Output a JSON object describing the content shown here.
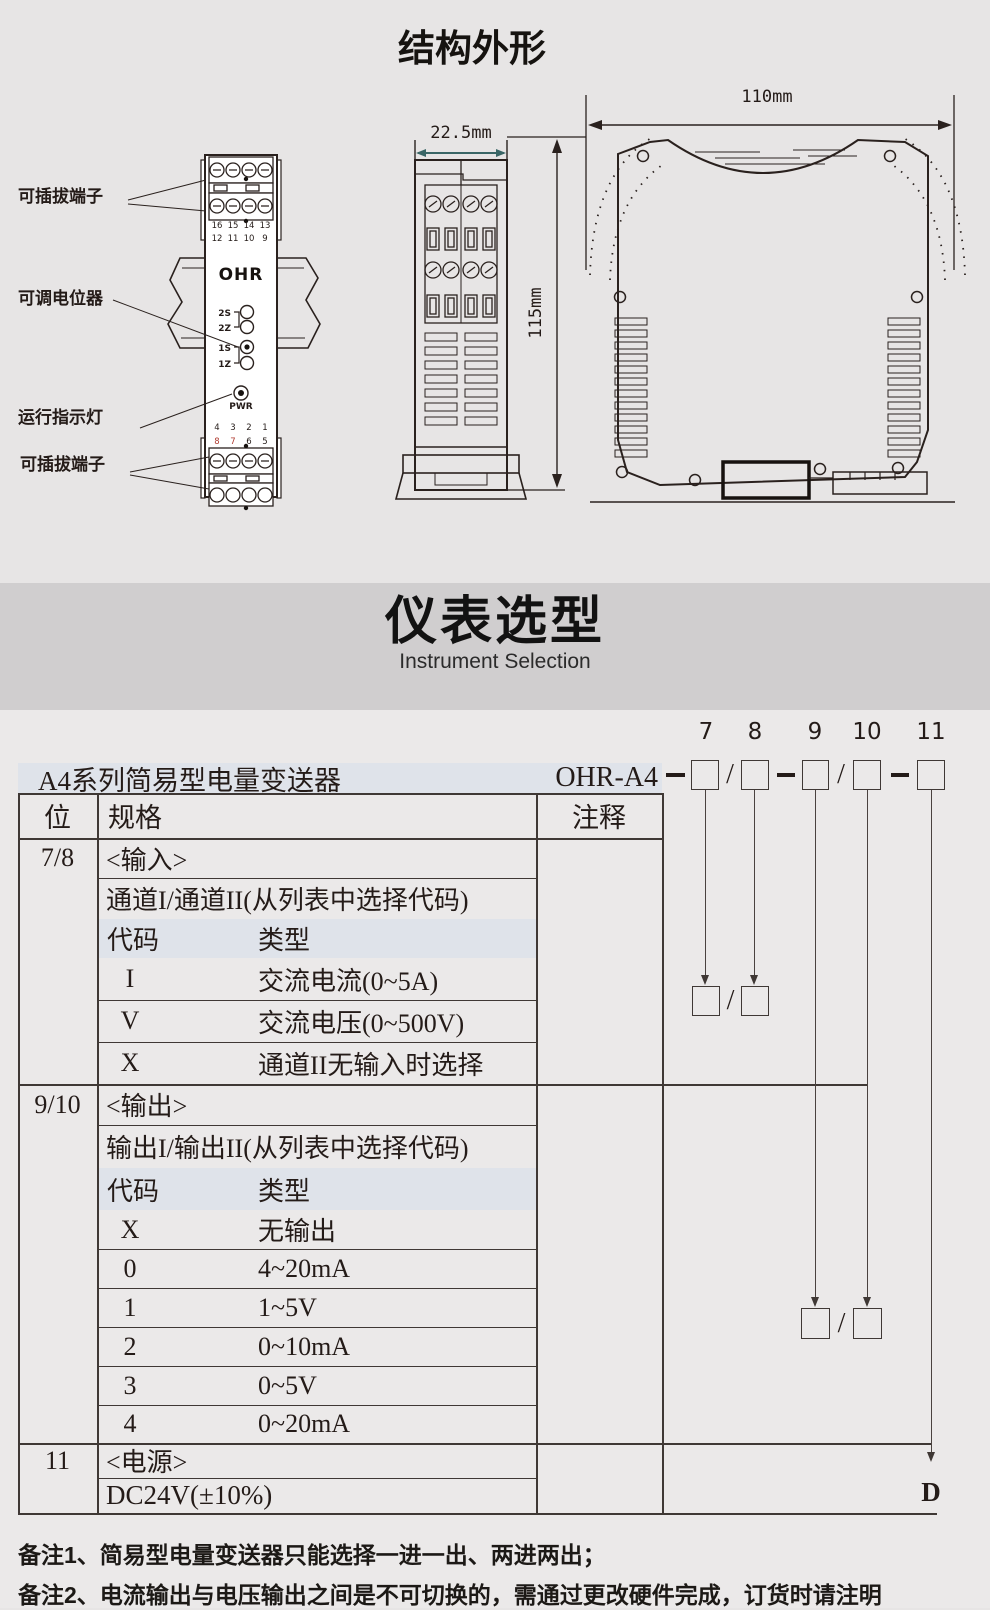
{
  "header": {
    "title": "结构外形"
  },
  "banner": {
    "title": "仪表选型",
    "subtitle": "Instrument Selection"
  },
  "colors": {
    "terminal_red": "#b03b30",
    "dim_teal": "#3a6666",
    "row_shade": "#dfe3ea"
  },
  "front_view": {
    "brand": "OHR",
    "label_terminals_top": "可插拔端子",
    "label_potentiometer": "可调电位器",
    "label_indicator": "运行指示灯",
    "label_terminals_bottom": "可插拔端子",
    "top_numbers": [
      "16",
      "15",
      "14",
      "13",
      "12",
      "11",
      "10",
      "9"
    ],
    "bottom_numbers_row1": [
      "4",
      "3",
      "2",
      "1"
    ],
    "bottom_numbers_row2": [
      "8",
      "7",
      "6",
      "5"
    ],
    "pots": [
      "2S",
      "2Z",
      "1S",
      "1Z"
    ],
    "led": "PWR"
  },
  "side_view": {
    "width": "22.5mm",
    "height": "115mm"
  },
  "profile_view": {
    "width": "110mm"
  },
  "model": {
    "prefix": "OHR-A4",
    "digits": [
      "7",
      "8",
      "9",
      "10",
      "11"
    ],
    "slash": "/",
    "suffix": "D"
  },
  "table": {
    "product": "A4系列简易型电量变送器",
    "col_pos": "位",
    "col_spec": "规格",
    "col_note": "注释",
    "s1": {
      "pos": "7/8",
      "heading": "<输入>",
      "sub": "通道I/通道II(从列表中选择代码)",
      "code_h": "代码",
      "type_h": "类型",
      "rows": [
        {
          "c": "I",
          "t": "交流电流(0~5A)"
        },
        {
          "c": "V",
          "t": "交流电压(0~500V)"
        },
        {
          "c": "X",
          "t": "通道II无输入时选择"
        }
      ]
    },
    "s2": {
      "pos": "9/10",
      "heading": "<输出>",
      "sub": "输出I/输出II(从列表中选择代码)",
      "code_h": "代码",
      "type_h": "类型",
      "rows": [
        {
          "c": "X",
          "t": "无输出"
        },
        {
          "c": "0",
          "t": "4~20mA"
        },
        {
          "c": "1",
          "t": "1~5V"
        },
        {
          "c": "2",
          "t": "0~10mA"
        },
        {
          "c": "3",
          "t": "0~5V"
        },
        {
          "c": "4",
          "t": "0~20mA"
        }
      ]
    },
    "s3": {
      "pos": "11",
      "heading": "<电源>",
      "sub": "DC24V(±10%)"
    }
  },
  "notes": {
    "n1": "备注1、简易型电量变送器只能选择一进一出、两进两出；",
    "n2": "备注2、电流输出与电压输出之间是不可切换的，需通过更改硬件完成，订货时请注明"
  }
}
